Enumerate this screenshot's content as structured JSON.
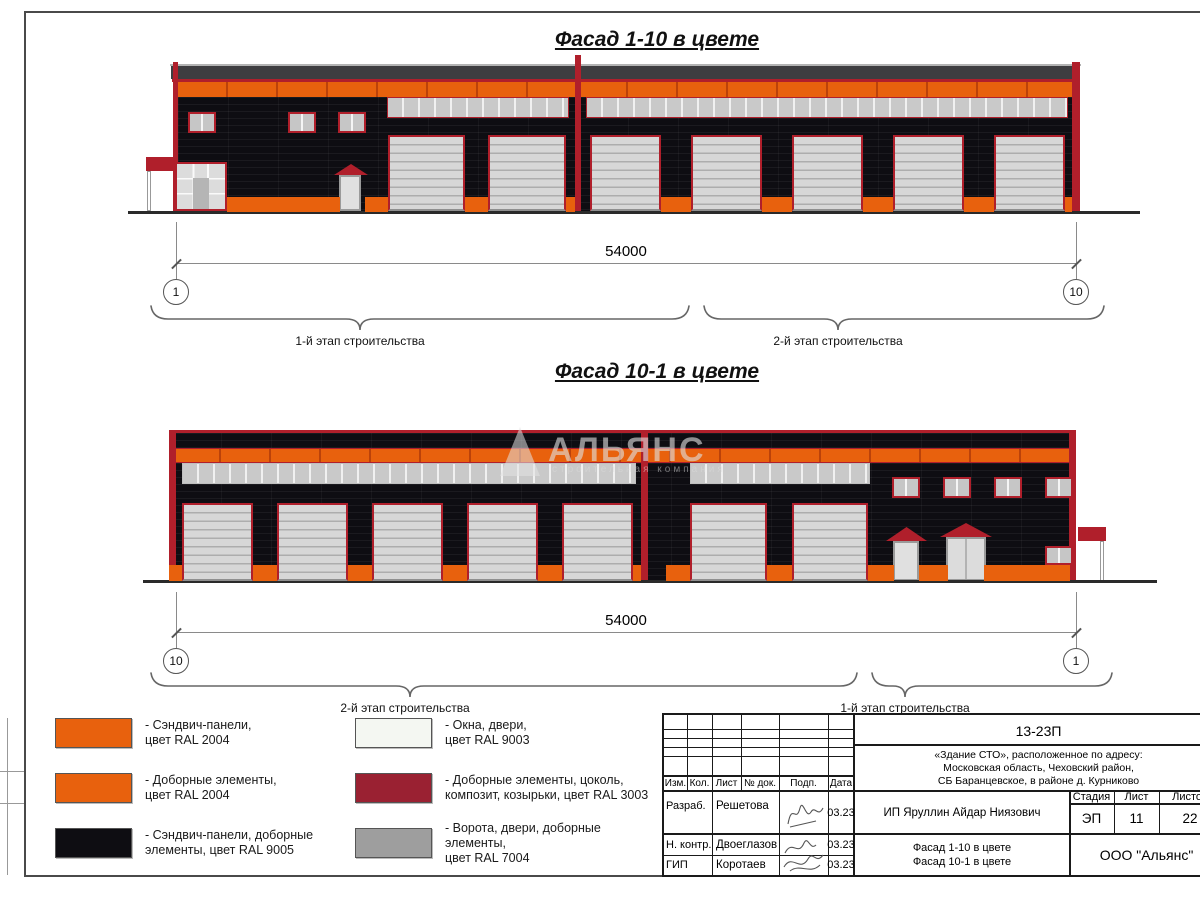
{
  "titles": {
    "facade1": "Фасад 1-10 в цвете",
    "facade2": "Фасад 10-1 в цвете"
  },
  "dim1": {
    "value": "54000",
    "axis_left": "1",
    "axis_right": "10",
    "stage_left": "1-й этап строительства",
    "stage_right": "2-й этап строительства"
  },
  "dim2": {
    "value": "54000",
    "axis_left": "10",
    "axis_right": "1",
    "stage_left": "2-й этап строительства",
    "stage_right": "1-й этап строительства"
  },
  "watermark": {
    "title": "АЛЬЯНС",
    "subtitle": "строительная компания"
  },
  "legend": {
    "items": [
      {
        "color": "#E8610D",
        "label": "- Сэндвич-панели,\nцвет RAL 2004"
      },
      {
        "color": "#E8610D",
        "label": "- Доборные элементы,\nцвет RAL 2004"
      },
      {
        "color": "#0E0D12",
        "label": "- Сэндвич-панели, доборные\nэлементы, цвет RAL 9005"
      },
      {
        "color": "#F4F7F2",
        "label": "- Окна, двери,\nцвет RAL 9003"
      },
      {
        "color": "#9A2132",
        "label": "- Доборные элементы, цоколь,\nкомпозит, козырьки, цвет RAL 3003"
      },
      {
        "color": "#9E9E9E",
        "label": "- Ворота, двери, доборные элементы,\nцвет RAL 7004"
      }
    ]
  },
  "titleblock": {
    "project_code": "13-23П",
    "project_desc": "«Здание СТО», расположенное по адресу:\nМосковская область, Чеховский район,\nСБ Баранцевское, в районе д. Курниково",
    "client": "ИП Яруллин Айдар Ниязович",
    "drawing_title": "Фасад 1-10 в цвете\nФасад 10-1 в цвете",
    "company": "ООО \"Альянс\"",
    "stage_label": "Стадия",
    "stage_value": "ЭП",
    "sheet_label": "Лист",
    "sheet_value": "11",
    "sheets_label": "Листов",
    "sheets_value": "22",
    "columns": [
      "Изм.",
      "Кол.",
      "Лист",
      "№ док.",
      "Подп.",
      "Дата"
    ],
    "signers": [
      {
        "role": "Разраб.",
        "name": "Решетова",
        "date": "03.23"
      },
      {
        "role": "Н. контр.",
        "name": "Двоеглазов",
        "date": "03.23"
      },
      {
        "role": "ГИП",
        "name": "Коротаев",
        "date": "03.23"
      }
    ]
  },
  "colors": {
    "ral2004_orange": "#E8610D",
    "ral9005_black": "#0E0D12",
    "ral3003_red": "#9A2132",
    "ral9003_white": "#F4F7F2",
    "ral7004_gray": "#9E9E9E",
    "trim_red": "#B01F2B"
  }
}
